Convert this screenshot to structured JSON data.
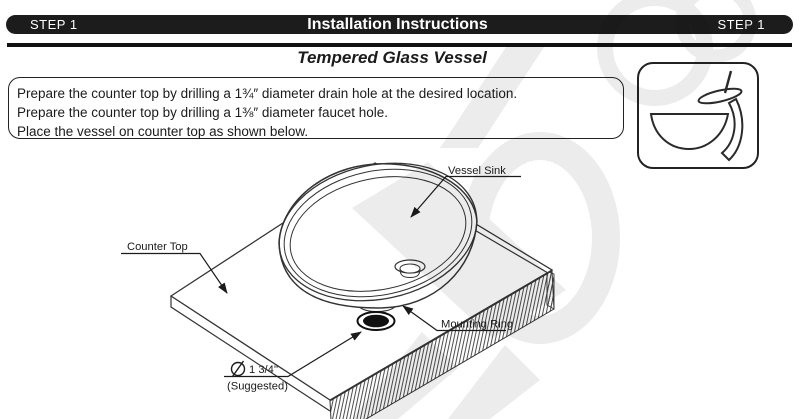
{
  "header": {
    "step_left": "STEP 1",
    "title": "Installation Instructions",
    "step_right": "STEP 1"
  },
  "subtitle": "Tempered Glass Vessel",
  "instructions": {
    "lines": [
      "Prepare the counter top by drilling a 1¾″ diameter drain hole at the desired location.",
      "Prepare the counter top by drilling a 1⅜″ diameter faucet hole.",
      "Place the vessel on counter top as shown below."
    ]
  },
  "diagram": {
    "labels": {
      "vessel_sink": "Vessel Sink",
      "counter_top": "Counter Top",
      "mounting_ring": "Mounting Ring",
      "drain_hole_size": "1 3/4''",
      "drain_hole_note": "(Suggested)"
    }
  },
  "icons": {
    "corner_icon": "vessel-sink-with-waterfall-faucet-icon",
    "diameter_symbol": "diameter-icon"
  },
  "colors": {
    "bar_background": "#1c1c1c",
    "bar_text": "#ffffff",
    "line_art": "#333333",
    "watermark": "#ececec"
  }
}
